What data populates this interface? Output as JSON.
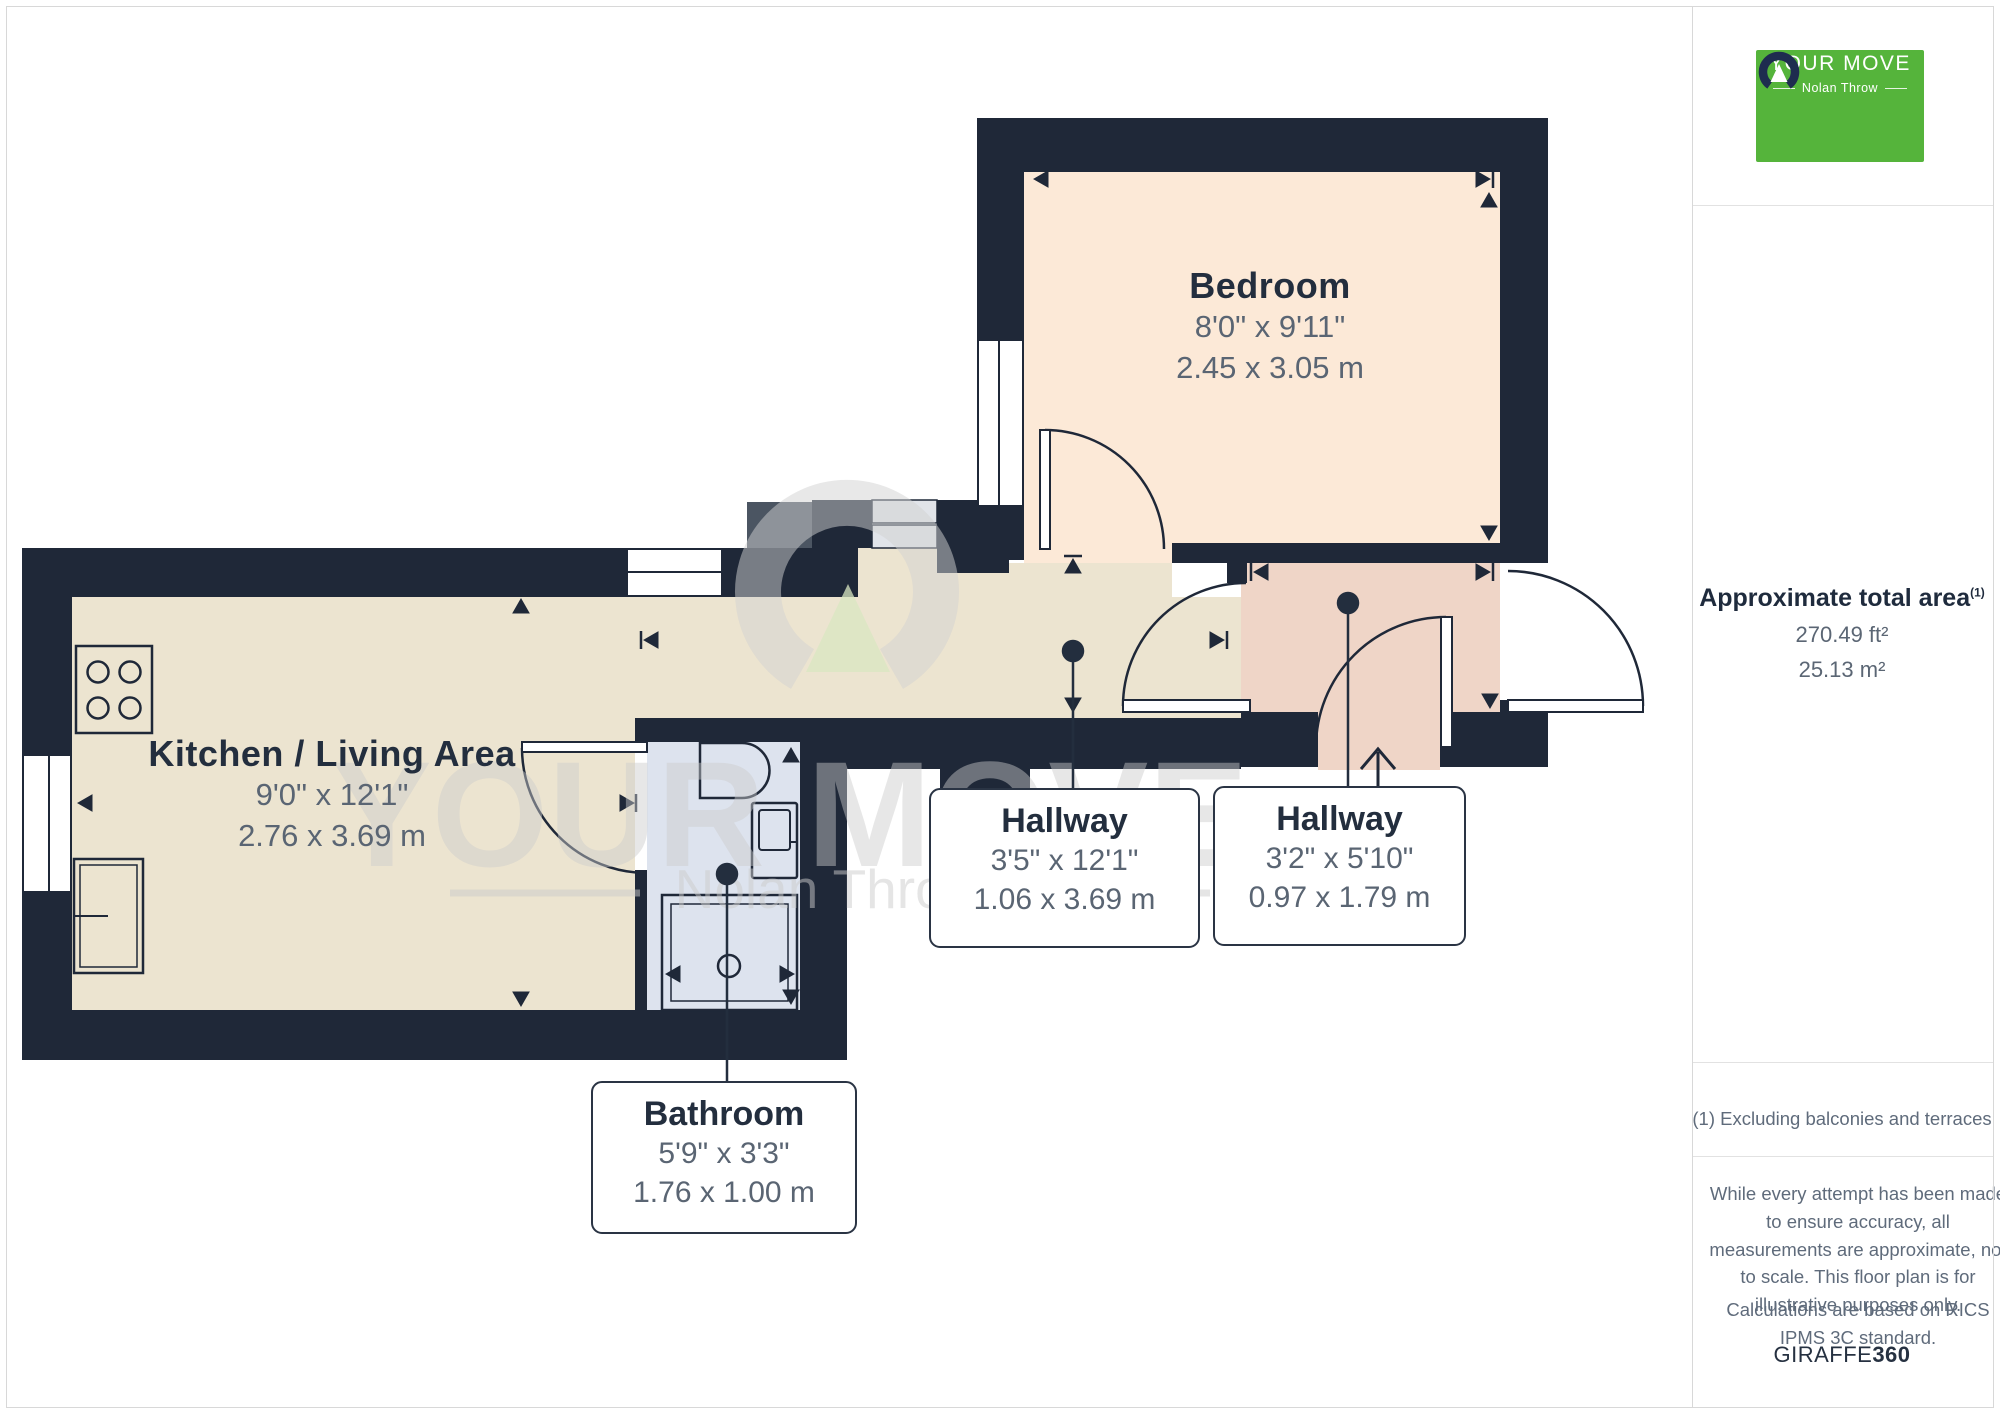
{
  "colors": {
    "wall": "#1f2838",
    "floor_kitchen": "#ece4d0",
    "floor_bedroom": "#fce9d7",
    "floor_hallway2": "#efd5c7",
    "floor_bathroom": "#dde3ee",
    "steps_light": "#e1e4e9",
    "steps_dark": "#4b5562",
    "brand_green": "#55b43b",
    "label_navy": "#232e3e",
    "dim_gray": "#5a6573",
    "watermark_gray": "#cccccc"
  },
  "rooms": {
    "bedroom": {
      "name": "Bedroom",
      "imperial": "8'0\" x 9'11\"",
      "metric": "2.45 x 3.05 m"
    },
    "kitchen": {
      "name": "Kitchen / Living Area",
      "imperial": "9'0\" x 12'1\"",
      "metric": "2.76 x 3.69 m"
    },
    "hallway1": {
      "name": "Hallway",
      "imperial": "3'5\" x 12'1\"",
      "metric": "1.06 x 3.69 m"
    },
    "hallway2": {
      "name": "Hallway",
      "imperial": "3'2\" x 5'10\"",
      "metric": "0.97 x 1.79 m"
    },
    "bathroom": {
      "name": "Bathroom",
      "imperial": "5'9\" x 3'3\"",
      "metric": "1.76 x 1.00 m"
    }
  },
  "watermark": {
    "line1": "YOUR MOVE",
    "line2": "Nolan Throw"
  },
  "sidebar": {
    "logo": {
      "brand": "YOUR MOVE",
      "subtitle": "Nolan Throw"
    },
    "area": {
      "title": "Approximate total area",
      "footnote_marker": "(1)",
      "imperial": "270.49 ft²",
      "metric": "25.13 m²"
    },
    "footnote": "(1) Excluding balconies and terraces",
    "disclaimer": "While every attempt has been made to ensure accuracy, all measurements are approximate, not to scale. This floor plan is for illustrative purposes only.",
    "standard": "Calculations are based on RICS IPMS 3C standard.",
    "credit_name": "GIRAFFE",
    "credit_suffix": "360"
  }
}
